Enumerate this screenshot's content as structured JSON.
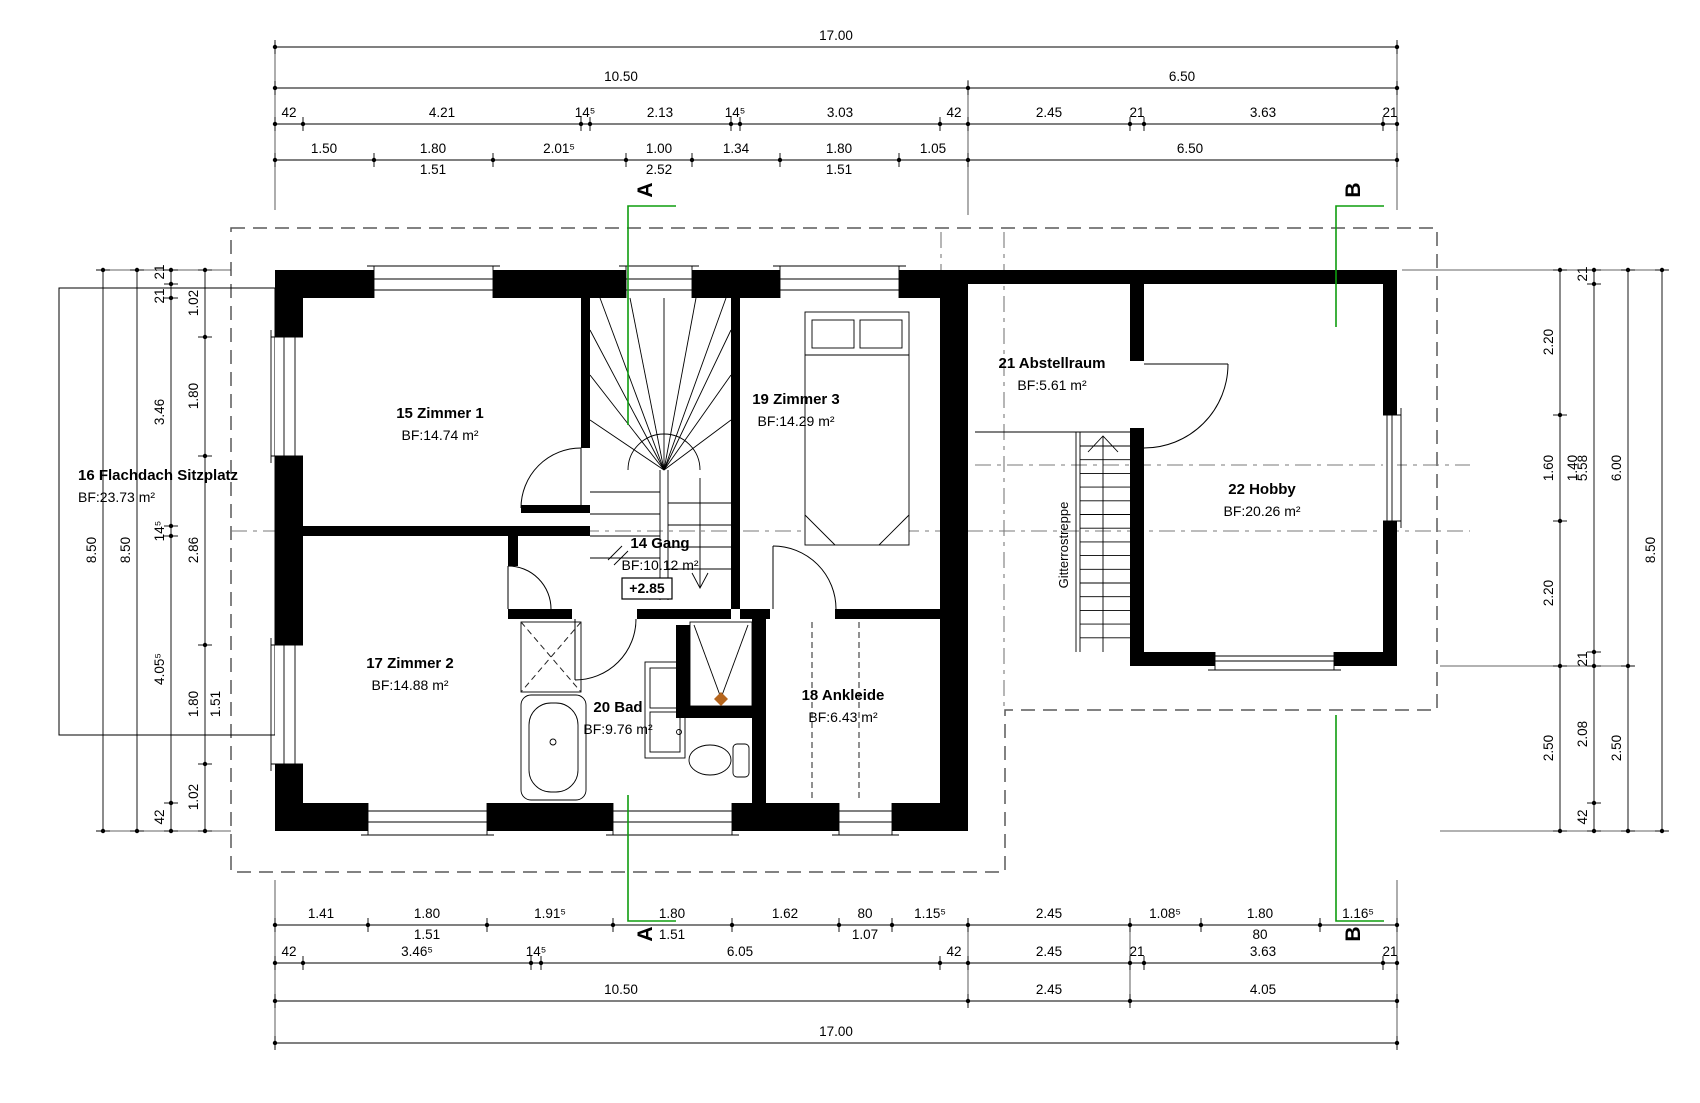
{
  "colors": {
    "accent_green": "#0f9d0f",
    "drain": "#b5651d",
    "wall": "#000000"
  },
  "level_marker": "+2.85",
  "stair_note": {
    "t": "Gitterrostreppe",
    "x": 1066,
    "y": 545
  },
  "rooms": [
    {
      "name": "15 Zimmer 1",
      "area": "BF:14.74 m²",
      "x": 440,
      "y": 418,
      "anchor": "middle"
    },
    {
      "name": "17 Zimmer 2",
      "area": "BF:14.88 m²",
      "x": 410,
      "y": 668,
      "anchor": "middle"
    },
    {
      "name": "19 Zimmer 3",
      "area": "BF:14.29 m²",
      "x": 796,
      "y": 404,
      "anchor": "middle"
    },
    {
      "name": "14 Gang",
      "area": "BF:10.12 m²",
      "x": 660,
      "y": 548,
      "anchor": "middle"
    },
    {
      "name": "20 Bad",
      "area": "BF:9.76 m²",
      "x": 618,
      "y": 712,
      "anchor": "middle"
    },
    {
      "name": "18 Ankleide",
      "area": "BF:6.43 m²",
      "x": 843,
      "y": 700,
      "anchor": "middle"
    },
    {
      "name": "21 Abstellraum",
      "area": "BF:5.61 m²",
      "x": 1052,
      "y": 368,
      "anchor": "middle"
    },
    {
      "name": "22 Hobby",
      "area": "BF:20.26 m²",
      "x": 1262,
      "y": 494,
      "anchor": "middle"
    },
    {
      "name": "16 Flachdach Sitzplatz",
      "area": "BF:23.73 m²",
      "x": 78,
      "y": 480,
      "anchor": "start"
    }
  ],
  "sections": [
    {
      "t": "A",
      "x": 652,
      "y": 190
    },
    {
      "t": "B",
      "x": 1360,
      "y": 190
    },
    {
      "t": "A",
      "x": 652,
      "y": 934
    },
    {
      "t": "B",
      "x": 1360,
      "y": 934
    }
  ],
  "dim_rows": [
    {
      "o": "h",
      "c": 47,
      "a": 275,
      "b": 1397,
      "pts": [
        275,
        1397
      ],
      "labels": [
        {
          "t": "17.00",
          "x": 836,
          "y": 40
        }
      ]
    },
    {
      "o": "h",
      "c": 88,
      "a": 275,
      "b": 1397,
      "pts": [
        275,
        968,
        1397
      ],
      "labels": [
        {
          "t": "10.50",
          "x": 621,
          "y": 81
        },
        {
          "t": "6.50",
          "x": 1182,
          "y": 81
        }
      ]
    },
    {
      "o": "h",
      "c": 124,
      "a": 275,
      "b": 1397,
      "pts": [
        275,
        303,
        581,
        590,
        731,
        740,
        940,
        968,
        1130,
        1144,
        1383,
        1397
      ],
      "labels": [
        {
          "t": "42",
          "x": 289,
          "y": 117
        },
        {
          "t": "4.21",
          "x": 442,
          "y": 117
        },
        {
          "t": "14⁵",
          "x": 585,
          "y": 117
        },
        {
          "t": "2.13",
          "x": 660,
          "y": 117
        },
        {
          "t": "14⁵",
          "x": 735,
          "y": 117
        },
        {
          "t": "3.03",
          "x": 840,
          "y": 117
        },
        {
          "t": "42",
          "x": 954,
          "y": 117
        },
        {
          "t": "2.45",
          "x": 1049,
          "y": 117
        },
        {
          "t": "21",
          "x": 1137,
          "y": 117
        },
        {
          "t": "3.63",
          "x": 1263,
          "y": 117
        },
        {
          "t": "21",
          "x": 1390,
          "y": 117
        }
      ]
    },
    {
      "o": "h",
      "c": 160,
      "a": 275,
      "b": 1397,
      "pts": [
        275,
        374,
        493,
        626,
        692,
        780,
        899,
        968,
        1397
      ],
      "labels": [
        {
          "t": "1.50",
          "x": 324,
          "y": 153
        },
        {
          "t": "1.80",
          "x": 433,
          "y": 153
        },
        {
          "t": "2.01⁵",
          "x": 559,
          "y": 153
        },
        {
          "t": "1.00",
          "x": 659,
          "y": 153
        },
        {
          "t": "1.34",
          "x": 736,
          "y": 153
        },
        {
          "t": "1.80",
          "x": 839,
          "y": 153
        },
        {
          "t": "1.05",
          "x": 933,
          "y": 153
        },
        {
          "t": "6.50",
          "x": 1190,
          "y": 153
        },
        {
          "t": "1.51",
          "x": 433,
          "y": 174
        },
        {
          "t": "2.52",
          "x": 659,
          "y": 174
        },
        {
          "t": "1.51",
          "x": 839,
          "y": 174
        }
      ]
    },
    {
      "o": "h",
      "c": 925,
      "a": 275,
      "b": 1397,
      "pts": [
        275,
        368,
        487,
        613,
        732,
        839,
        892,
        968,
        1130,
        1201,
        1320,
        1397
      ],
      "labels": [
        {
          "t": "1.41",
          "x": 321,
          "y": 918
        },
        {
          "t": "1.80",
          "x": 427,
          "y": 918
        },
        {
          "t": "1.91⁵",
          "x": 550,
          "y": 918
        },
        {
          "t": "1.80",
          "x": 672,
          "y": 918
        },
        {
          "t": "1.62",
          "x": 785,
          "y": 918
        },
        {
          "t": "80",
          "x": 865,
          "y": 918
        },
        {
          "t": "1.15⁵",
          "x": 930,
          "y": 918
        },
        {
          "t": "2.45",
          "x": 1049,
          "y": 918
        },
        {
          "t": "1.08⁵",
          "x": 1165,
          "y": 918
        },
        {
          "t": "1.80",
          "x": 1260,
          "y": 918
        },
        {
          "t": "1.16⁵",
          "x": 1358,
          "y": 918
        },
        {
          "t": "1.51",
          "x": 427,
          "y": 939
        },
        {
          "t": "1.51",
          "x": 672,
          "y": 939
        },
        {
          "t": "1.07",
          "x": 865,
          "y": 939
        },
        {
          "t": "80",
          "x": 1260,
          "y": 939
        }
      ]
    },
    {
      "o": "h",
      "c": 963,
      "a": 275,
      "b": 1397,
      "pts": [
        275,
        303,
        531,
        541,
        940,
        968,
        1130,
        1144,
        1383,
        1397
      ],
      "labels": [
        {
          "t": "42",
          "x": 289,
          "y": 956
        },
        {
          "t": "3.46⁵",
          "x": 417,
          "y": 956
        },
        {
          "t": "14⁵",
          "x": 536,
          "y": 956
        },
        {
          "t": "6.05",
          "x": 740,
          "y": 956
        },
        {
          "t": "42",
          "x": 954,
          "y": 956
        },
        {
          "t": "2.45",
          "x": 1049,
          "y": 956
        },
        {
          "t": "21",
          "x": 1137,
          "y": 956
        },
        {
          "t": "3.63",
          "x": 1263,
          "y": 956
        },
        {
          "t": "21",
          "x": 1390,
          "y": 956
        }
      ]
    },
    {
      "o": "h",
      "c": 1001,
      "a": 275,
      "b": 1397,
      "pts": [
        275,
        968,
        1130,
        1397
      ],
      "labels": [
        {
          "t": "10.50",
          "x": 621,
          "y": 994
        },
        {
          "t": "2.45",
          "x": 1049,
          "y": 994
        },
        {
          "t": "4.05",
          "x": 1263,
          "y": 994
        }
      ]
    },
    {
      "o": "h",
      "c": 1043,
      "a": 275,
      "b": 1397,
      "pts": [
        275,
        1397
      ],
      "labels": [
        {
          "t": "17.00",
          "x": 836,
          "y": 1036
        }
      ]
    },
    {
      "o": "v",
      "c": 103,
      "a": 270,
      "b": 831,
      "pts": [
        270,
        831
      ],
      "labels": [
        {
          "t": "8.50",
          "x": 96,
          "y": 550
        }
      ]
    },
    {
      "o": "v",
      "c": 137,
      "a": 270,
      "b": 831,
      "pts": [
        270,
        831
      ],
      "labels": [
        {
          "t": "8.50",
          "x": 130,
          "y": 550
        }
      ]
    },
    {
      "o": "v",
      "c": 171,
      "a": 270,
      "b": 831,
      "pts": [
        270,
        284,
        298,
        526,
        536,
        803,
        831
      ],
      "labels": [
        {
          "t": "21",
          "x": 164,
          "y": 272
        },
        {
          "t": "21",
          "x": 164,
          "y": 296
        },
        {
          "t": "3.46",
          "x": 164,
          "y": 412
        },
        {
          "t": "14⁵",
          "x": 164,
          "y": 531
        },
        {
          "t": "4.05⁵",
          "x": 164,
          "y": 669
        },
        {
          "t": "42",
          "x": 164,
          "y": 817
        }
      ]
    },
    {
      "o": "v",
      "c": 205,
      "a": 270,
      "b": 831,
      "pts": [
        270,
        337,
        456,
        645,
        764,
        831
      ],
      "labels": [
        {
          "t": "1.02",
          "x": 198,
          "y": 303
        },
        {
          "t": "1.80",
          "x": 198,
          "y": 396
        },
        {
          "t": "2.86",
          "x": 198,
          "y": 550
        },
        {
          "t": "1.80",
          "x": 198,
          "y": 704
        },
        {
          "t": "1.51",
          "x": 220,
          "y": 704
        },
        {
          "t": "1.02",
          "x": 198,
          "y": 797
        }
      ]
    },
    {
      "o": "v",
      "c": 1560,
      "a": 270,
      "b": 831,
      "pts": [
        270,
        415,
        521,
        666,
        831
      ],
      "labels": [
        {
          "t": "2.20",
          "x": 1553,
          "y": 342
        },
        {
          "t": "1.60",
          "x": 1553,
          "y": 468
        },
        {
          "t": "1.40",
          "x": 1577,
          "y": 468
        },
        {
          "t": "2.20",
          "x": 1553,
          "y": 593
        },
        {
          "t": "2.50",
          "x": 1553,
          "y": 748
        }
      ]
    },
    {
      "o": "v",
      "c": 1594,
      "a": 270,
      "b": 831,
      "pts": [
        270,
        284,
        652,
        666,
        803,
        831
      ],
      "labels": [
        {
          "t": "21",
          "x": 1587,
          "y": 274
        },
        {
          "t": "5.58",
          "x": 1587,
          "y": 468
        },
        {
          "t": "21",
          "x": 1587,
          "y": 659
        },
        {
          "t": "2.08",
          "x": 1587,
          "y": 734
        },
        {
          "t": "42",
          "x": 1587,
          "y": 817
        }
      ]
    },
    {
      "o": "v",
      "c": 1628,
      "a": 270,
      "b": 831,
      "pts": [
        270,
        666,
        831
      ],
      "labels": [
        {
          "t": "6.00",
          "x": 1621,
          "y": 468
        },
        {
          "t": "2.50",
          "x": 1621,
          "y": 748
        }
      ]
    },
    {
      "o": "v",
      "c": 1662,
      "a": 270,
      "b": 831,
      "pts": [
        270,
        831
      ],
      "labels": [
        {
          "t": "8.50",
          "x": 1655,
          "y": 550
        }
      ]
    }
  ]
}
